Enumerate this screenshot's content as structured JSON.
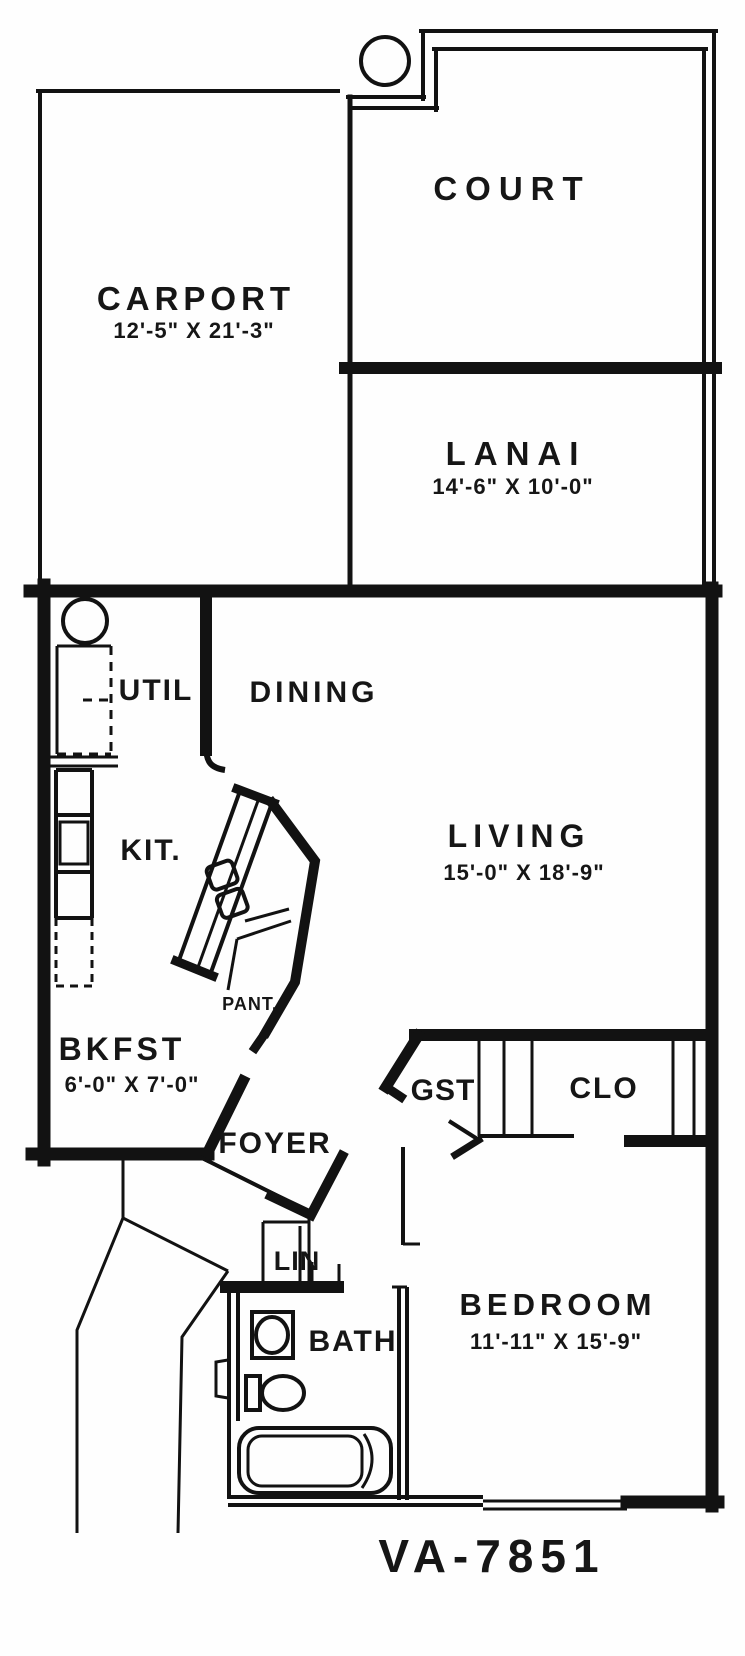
{
  "plan": {
    "number": "VA-7851",
    "labels": {
      "court": "COURT",
      "carport": "CARPORT",
      "carport_dims": "12'-5\" X 21'-3\"",
      "lanai": "LANAI",
      "lanai_dims": "14'-6\" X 10'-0\"",
      "util": "UTIL",
      "dining": "DINING",
      "kitchen": "KIT.",
      "living": "LIVING",
      "living_dims": "15'-0\" X 18'-9\"",
      "pantry": "PANT.",
      "breakfast": "BKFST",
      "breakfast_dims": "6'-0\" X 7'-0\"",
      "guest_closet": "GST",
      "closet": "CLO",
      "foyer": "FOYER",
      "linen": "LIN",
      "bath": "BATH",
      "bedroom": "BEDROOM",
      "bedroom_dims": "11'-11\" X 15'-9\""
    },
    "colors": {
      "ink": "#121212",
      "paper": "#fefefe"
    }
  }
}
